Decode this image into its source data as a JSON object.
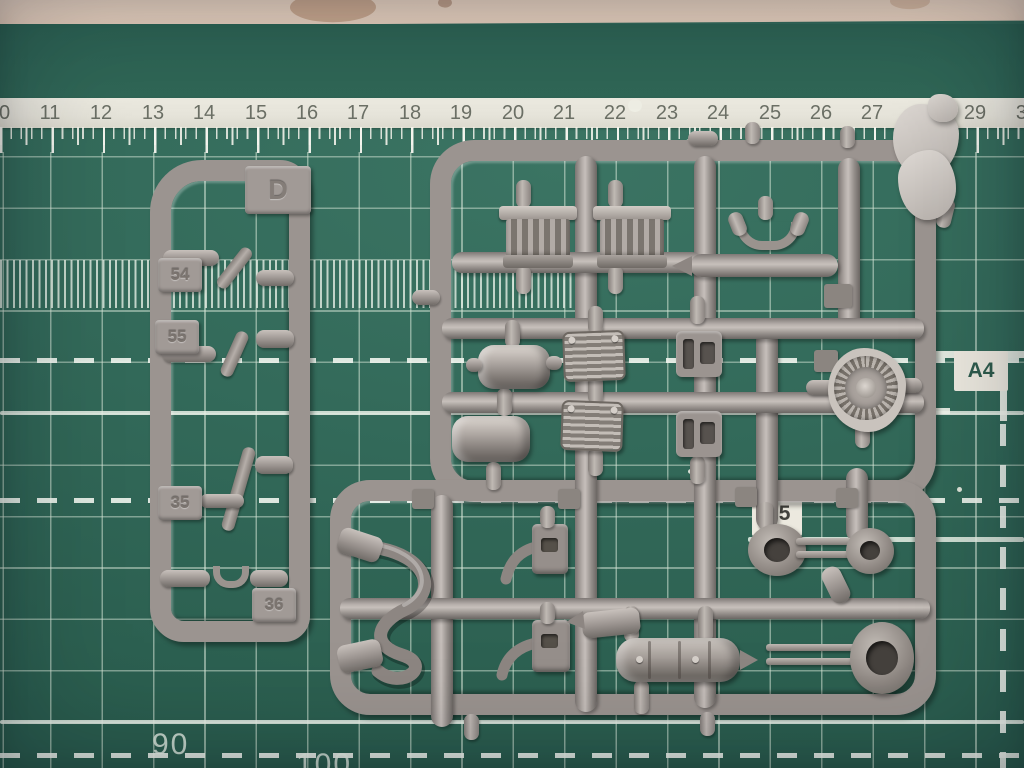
{
  "ruler": {
    "numbers": [
      "10",
      "11",
      "12",
      "13",
      "14",
      "15",
      "16",
      "17",
      "18",
      "19",
      "20",
      "21",
      "22",
      "23",
      "24",
      "25",
      "26",
      "27",
      "28",
      "29",
      "30"
    ]
  },
  "mat_markings": {
    "size_a4": "A4",
    "size_b5": "B5",
    "coord_left": "90",
    "coord_mid": "100"
  },
  "sprue_d": {
    "gate_letter": "D",
    "part_numbers": [
      "54",
      "55",
      "35",
      "36"
    ]
  },
  "palette": {
    "mat_green": "#336a5a",
    "grid_line": "#d4e4d5",
    "plastic_gray": "#9b9490",
    "ruler_strip": "#e9e7dd"
  }
}
